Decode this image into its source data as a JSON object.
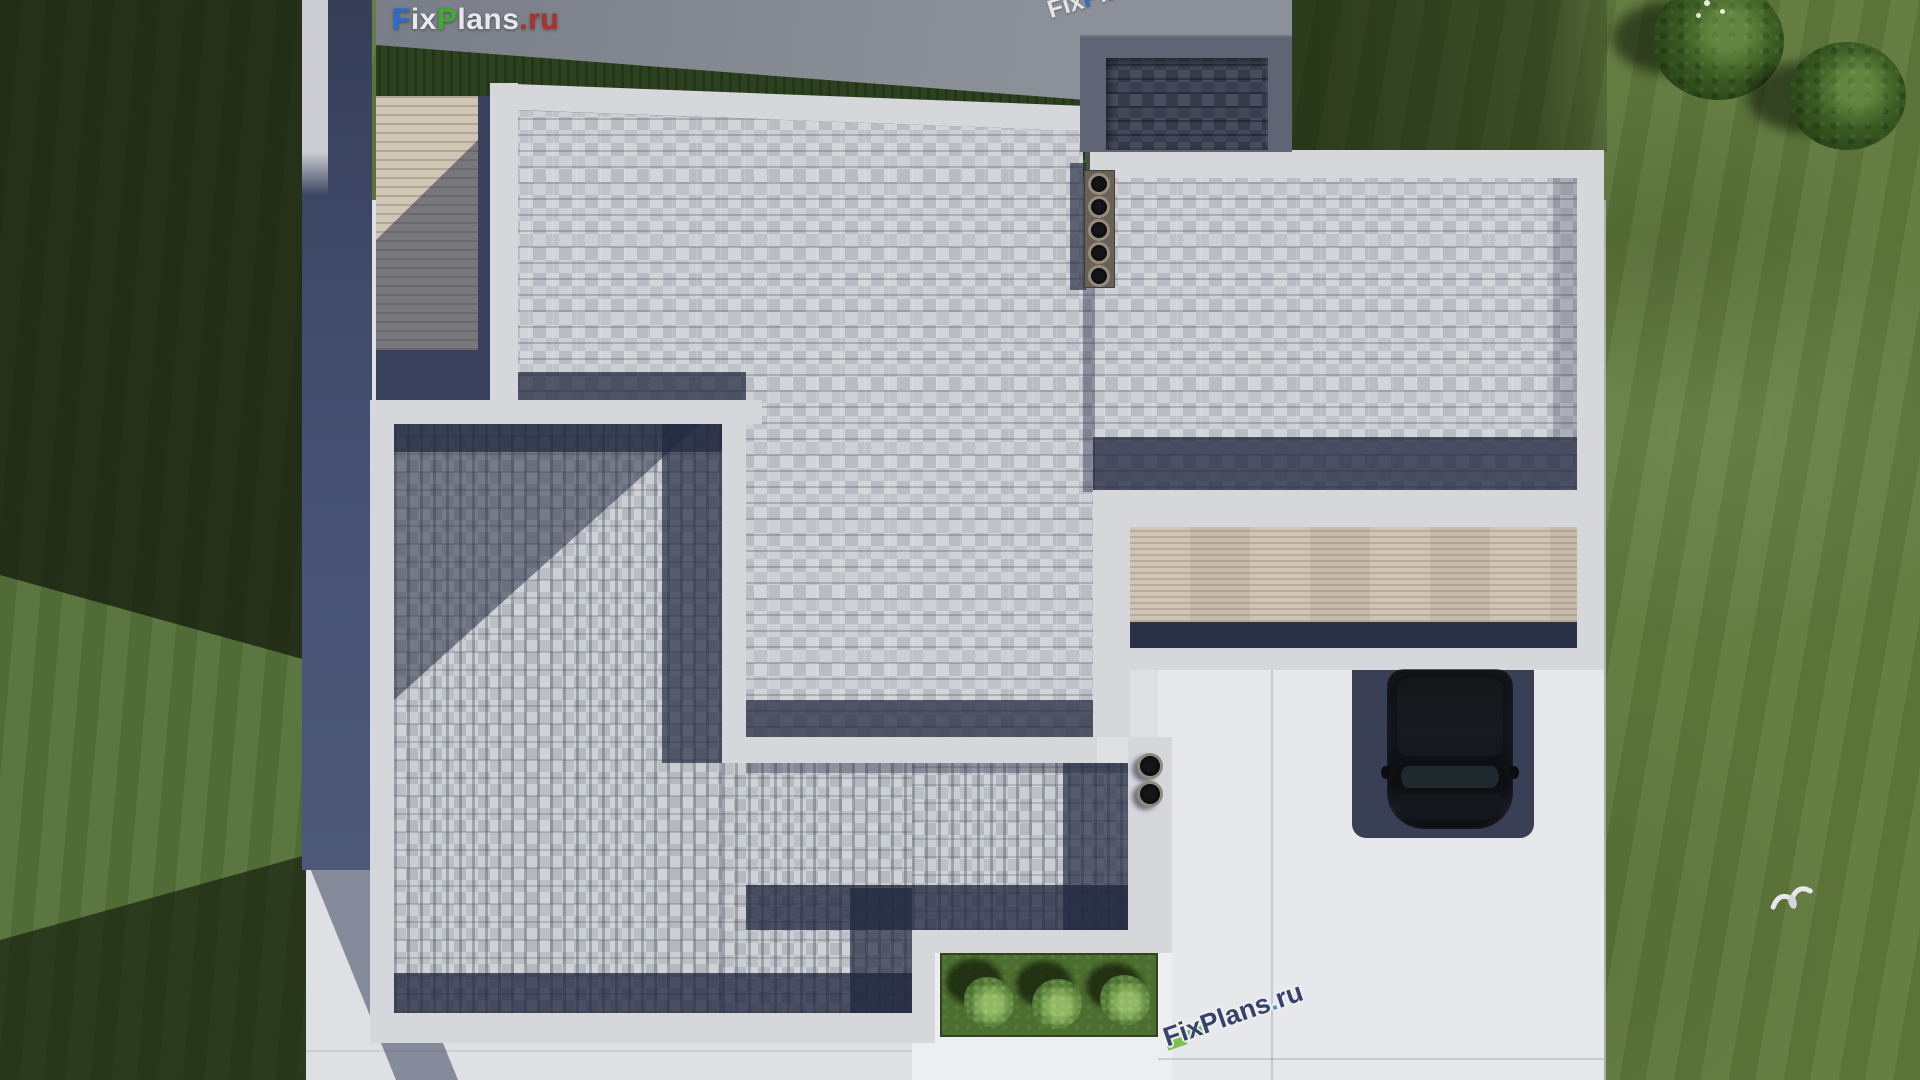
{
  "branding": {
    "logo": {
      "f": "F",
      "ix": "ix",
      "p": "P",
      "lans": "lans",
      "dotru": ".ru"
    },
    "watermark_top": {
      "fix": "Fix",
      "p": "P",
      "rest": "lans.ru"
    },
    "watermark_bottom": {
      "main": "FixPlans",
      "dot": ".",
      "tail": "ru"
    }
  },
  "palette": {
    "lawn": "#60793c",
    "lawn_shadow": "#16230c",
    "pavement": "#dfe0e3",
    "parapet_white": "#d6d7db",
    "shingle_light": "#c7c9ce",
    "shingle_dark": "#3a4150",
    "shadow_navy": "#1f2640",
    "deck_wood": "#d0c6b6",
    "canopy_wood": "#cdc2b2",
    "north_walkway_gray": "#878b94",
    "hedge_green": "#2c411f",
    "car_black": "#0c0e11",
    "bush_green": "#6fa04a",
    "logo_blue": "#2a6bd3",
    "logo_green": "#3fae28",
    "logo_red": "#aa3326",
    "watermark_navy": "#2d3a63"
  }
}
